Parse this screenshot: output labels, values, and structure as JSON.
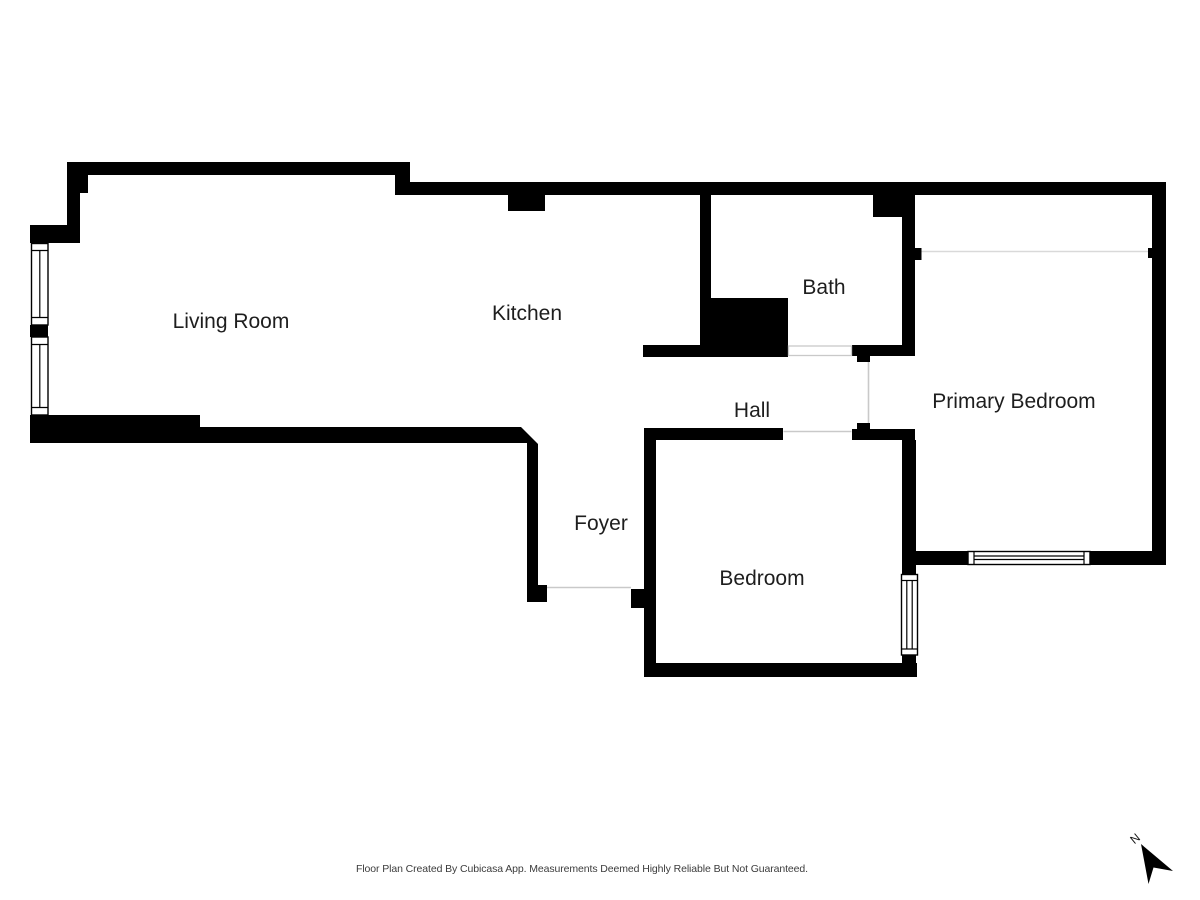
{
  "rooms": [
    {
      "name": "Living Room"
    },
    {
      "name": "Kitchen"
    },
    {
      "name": "Bath"
    },
    {
      "name": "Hall"
    },
    {
      "name": "Primary Bedroom"
    },
    {
      "name": "Foyer"
    },
    {
      "name": "Bedroom"
    }
  ],
  "footer": {
    "text": "Floor Plan Created By Cubicasa App. Measurements Deemed Highly Reliable But Not Guaranteed."
  },
  "compass": {
    "north_label": "N"
  },
  "colors": {
    "wall": "#000000",
    "room_label": "#1e1e1e",
    "footer_text": "#3c3c3c",
    "opening_line": "#c9c9c9",
    "divider_line": "#d9d9d9",
    "background": "#ffffff"
  }
}
